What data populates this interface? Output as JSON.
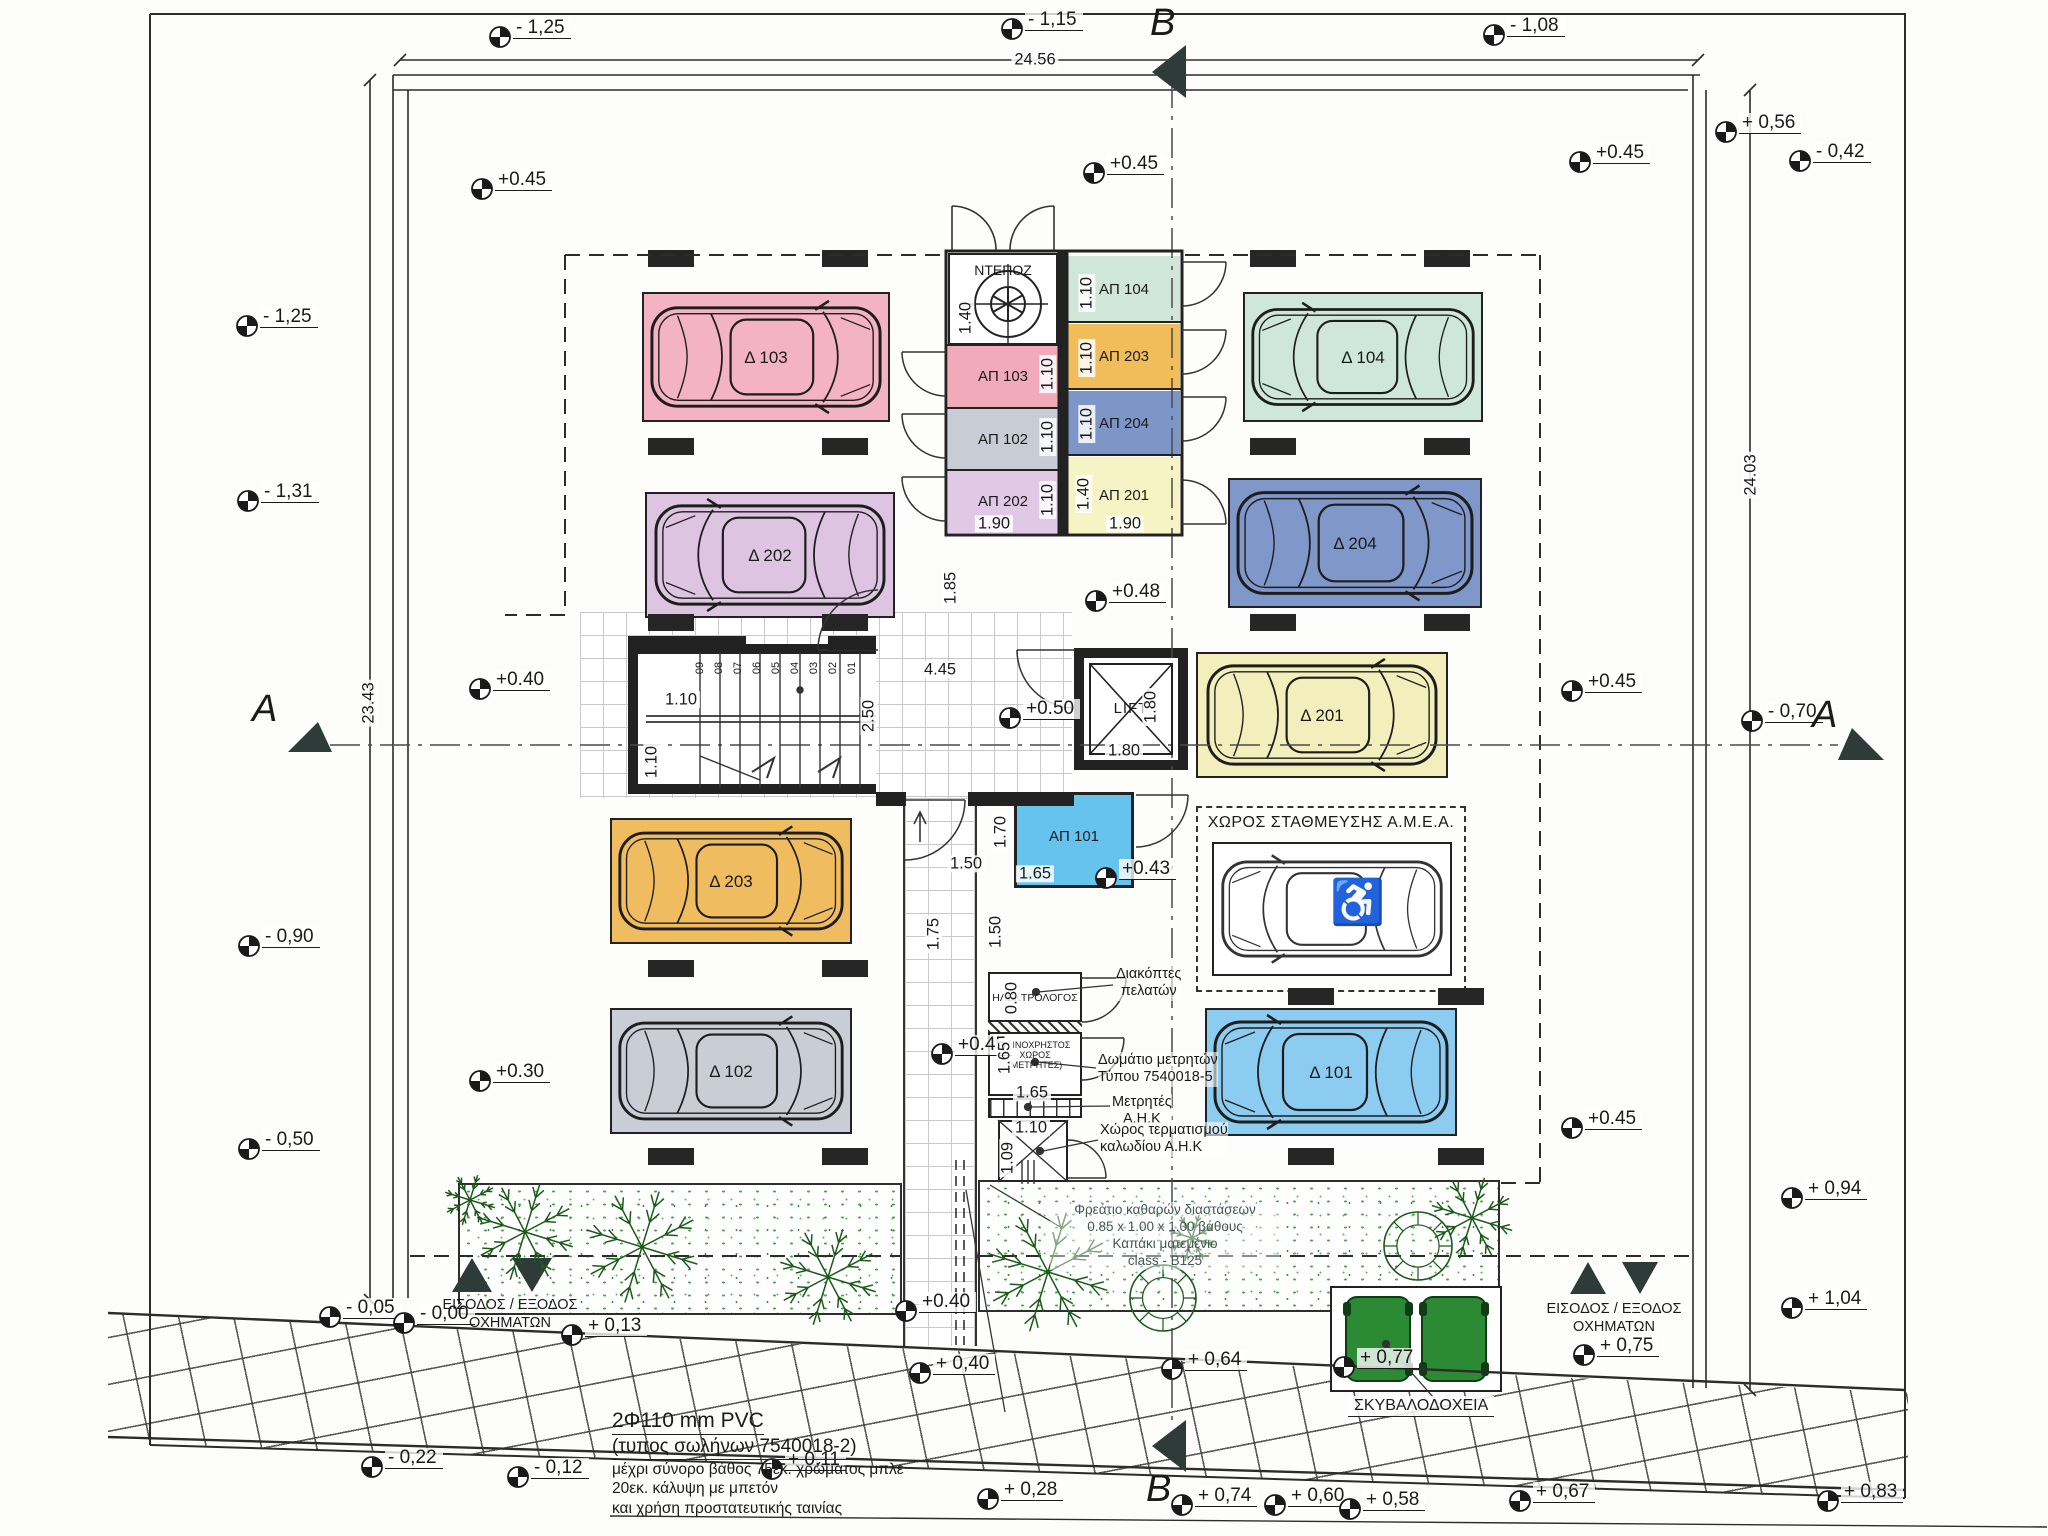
{
  "drawing": {
    "dim_top": "24.56",
    "dim_left": "23.43",
    "dim_right": "24.03",
    "section_a": "A",
    "section_b": "B"
  },
  "core": {
    "lift": "LIFT",
    "deposit": "ΝΤΕΠΟΖ",
    "steps": [
      "09",
      "08",
      "07",
      "06",
      "05",
      "04",
      "03",
      "02",
      "01"
    ]
  },
  "parking": [
    {
      "id": "Δ 103",
      "color": "#f3b3c2"
    },
    {
      "id": "Δ 104",
      "color": "#cfe7da"
    },
    {
      "id": "Δ 202",
      "color": "#ddc5e1"
    },
    {
      "id": "Δ 204",
      "color": "#8097c9"
    },
    {
      "id": "Δ 201",
      "color": "#f3efbc"
    },
    {
      "id": "Δ 203",
      "color": "#efbc60"
    },
    {
      "id": "Δ 102",
      "color": "#c9cdd6"
    },
    {
      "id": "Δ 101",
      "color": "#8cccf0"
    }
  ],
  "storages": [
    {
      "label": "ΑΠ 103",
      "color": "#f0aaba"
    },
    {
      "label": "ΑΠ 102",
      "color": "#c7ccd5"
    },
    {
      "label": "ΑΠ 202",
      "color": "#e0c9e4"
    },
    {
      "label": "ΑΠ 104",
      "color": "#cfe6d9"
    },
    {
      "label": "ΑΠ 203",
      "color": "#f0bd5a"
    },
    {
      "label": "ΑΠ 204",
      "color": "#7e95c8"
    },
    {
      "label": "ΑΠ 201",
      "color": "#f6f3c4"
    }
  ],
  "storage_101": {
    "label": "ΑΠ 101",
    "color": "#66c3ed"
  },
  "amea": {
    "title": "ΧΩΡΟΣ ΣΤΑΘΜΕΥΣΗΣ Α.Μ.Ε.Α.",
    "symbol": "♿"
  },
  "tech": {
    "electrician": "ΗΛΕΚΤΡΟΛΟΓΟΣ",
    "meters_room": [
      "ΚΟΙΝΟΧΡΗΣΤΟΣ",
      "ΧΩΡΟΣ",
      "(ΜΕΤΡΗΤΕΣ)"
    ],
    "ann_switches": [
      "Διακόπτες",
      "πελατών"
    ],
    "ann_meter_room": [
      "Δωμάτιο μετρητών",
      "Τύπου 7540018-5"
    ],
    "ann_meters": [
      "Μετρητές",
      "Α.Η.Κ"
    ],
    "ann_cable": [
      "Χώρος τερματισμού",
      "καλωδίου Α.Η.Κ"
    ]
  },
  "entrances": {
    "line1": "ΕΙΣΟΔΟΣ / ΕΞΟΔΟΣ",
    "line2": "ΟΧΗΜΑΤΩΝ"
  },
  "bins": {
    "label": "ΣΚΥΒΑΛΟΔΟΧΕΙΑ",
    "color": "#2b8a33"
  },
  "notes": {
    "manhole": [
      "Φρεάτιο καθαρών διαστάσεων",
      "0.85 x 1.00 x 1.00 βάθους",
      "Καπάκι ματεμένιο",
      "class - B125"
    ],
    "pvc": [
      "2Φ110 mm PVC",
      "(τυπος σωλήνων  7540018-2)",
      "μέχρι σύνορο βάθος 75εκ.  χρώματος μπλε",
      "20εκ. κάλυψη με μπετόν",
      "και χρήση προστατευτικής ταινίας"
    ]
  },
  "elevations": [
    {
      "v": "- 1,25",
      "x": 500,
      "y": 38
    },
    {
      "v": "- 1,15",
      "x": 1012,
      "y": 30
    },
    {
      "v": "- 1,08",
      "x": 1494,
      "y": 36
    },
    {
      "v": "+ 0,56",
      "x": 1726,
      "y": 133
    },
    {
      "v": "- 0,42",
      "x": 1800,
      "y": 162
    },
    {
      "v": "+0.45",
      "x": 482,
      "y": 190
    },
    {
      "v": "+0.45",
      "x": 1094,
      "y": 174
    },
    {
      "v": "+0.45",
      "x": 1580,
      "y": 163
    },
    {
      "v": "- 1,25",
      "x": 247,
      "y": 327
    },
    {
      "v": "- 1,31",
      "x": 248,
      "y": 502
    },
    {
      "v": "+0.40",
      "x": 480,
      "y": 690
    },
    {
      "v": "+0.45",
      "x": 1572,
      "y": 692
    },
    {
      "v": "- 0,70",
      "x": 1752,
      "y": 722
    },
    {
      "v": "+0.48",
      "x": 1096,
      "y": 602
    },
    {
      "v": "+0.50",
      "x": 1010,
      "y": 719
    },
    {
      "v": "+0.43",
      "x": 1106,
      "y": 879
    },
    {
      "v": "+0.45",
      "x": 942,
      "y": 1055
    },
    {
      "v": "- 0,90",
      "x": 249,
      "y": 947
    },
    {
      "v": "- 0,50",
      "x": 249,
      "y": 1150
    },
    {
      "v": "+0.30",
      "x": 480,
      "y": 1082
    },
    {
      "v": "+0.45",
      "x": 1572,
      "y": 1129
    },
    {
      "v": "+ 0,94",
      "x": 1792,
      "y": 1199
    },
    {
      "v": "+ 1,04",
      "x": 1792,
      "y": 1309
    },
    {
      "v": "- 0,05",
      "x": 330,
      "y": 1318
    },
    {
      "v": "- 0,00",
      "x": 404,
      "y": 1324
    },
    {
      "v": "+ 0,13",
      "x": 572,
      "y": 1336
    },
    {
      "v": "+0.40",
      "x": 906,
      "y": 1312
    },
    {
      "v": "+ 0,40",
      "x": 920,
      "y": 1374
    },
    {
      "v": "+ 0,64",
      "x": 1172,
      "y": 1370
    },
    {
      "v": "+ 0,77",
      "x": 1344,
      "y": 1368
    },
    {
      "v": "+ 0,75",
      "x": 1584,
      "y": 1356
    },
    {
      "v": "- 0,22",
      "x": 372,
      "y": 1468
    },
    {
      "v": "- 0,12",
      "x": 518,
      "y": 1478
    },
    {
      "v": "+ 0,11",
      "x": 772,
      "y": 1470
    },
    {
      "v": "+ 0,28",
      "x": 988,
      "y": 1500
    },
    {
      "v": "+ 0,74",
      "x": 1182,
      "y": 1506
    },
    {
      "v": "+ 0,60",
      "x": 1275,
      "y": 1506
    },
    {
      "v": "+ 0,58",
      "x": 1350,
      "y": 1510
    },
    {
      "v": "+ 0,67",
      "x": 1520,
      "y": 1502
    },
    {
      "v": "+ 0,83",
      "x": 1828,
      "y": 1502
    }
  ],
  "dims": [
    {
      "v": "24.56",
      "x": 1035,
      "y": 60,
      "r": 0
    },
    {
      "v": "23.43",
      "x": 369,
      "y": 703,
      "r": -90
    },
    {
      "v": "24.03",
      "x": 1751,
      "y": 475,
      "r": -90
    },
    {
      "v": "1.40",
      "x": 966,
      "y": 318,
      "r": -90
    },
    {
      "v": "1.10",
      "x": 1048,
      "y": 374,
      "r": -90
    },
    {
      "v": "1.10",
      "x": 1048,
      "y": 437,
      "r": -90
    },
    {
      "v": "1.10",
      "x": 1048,
      "y": 500,
      "r": -90
    },
    {
      "v": "1.10",
      "x": 1087,
      "y": 293,
      "r": -90
    },
    {
      "v": "1.10",
      "x": 1087,
      "y": 358,
      "r": -90
    },
    {
      "v": "1.10",
      "x": 1087,
      "y": 424,
      "r": -90
    },
    {
      "v": "1.40",
      "x": 1084,
      "y": 494,
      "r": -90
    },
    {
      "v": "1.90",
      "x": 994,
      "y": 524,
      "r": 0
    },
    {
      "v": "1.90",
      "x": 1125,
      "y": 524,
      "r": 0
    },
    {
      "v": "1.85",
      "x": 951,
      "y": 588,
      "r": -90
    },
    {
      "v": "4.45",
      "x": 940,
      "y": 670,
      "r": 0
    },
    {
      "v": "2.50",
      "x": 869,
      "y": 716,
      "r": -90
    },
    {
      "v": "1.10",
      "x": 681,
      "y": 700,
      "r": 0
    },
    {
      "v": "1.10",
      "x": 652,
      "y": 762,
      "r": -90
    },
    {
      "v": "1.80",
      "x": 1124,
      "y": 751,
      "r": 0
    },
    {
      "v": "1.80",
      "x": 1151,
      "y": 707,
      "r": -90
    },
    {
      "v": "1.50",
      "x": 966,
      "y": 864,
      "r": 0
    },
    {
      "v": "1.70",
      "x": 1001,
      "y": 832,
      "r": -90
    },
    {
      "v": "1.65",
      "x": 1035,
      "y": 874,
      "r": 0
    },
    {
      "v": "1.50",
      "x": 996,
      "y": 932,
      "r": -90
    },
    {
      "v": "1.75",
      "x": 934,
      "y": 934,
      "r": -90
    },
    {
      "v": "0.80",
      "x": 1012,
      "y": 998,
      "r": -90
    },
    {
      "v": "1.65",
      "x": 1005,
      "y": 1058,
      "r": -90
    },
    {
      "v": "1.65",
      "x": 1032,
      "y": 1093,
      "r": 0
    },
    {
      "v": "1.10",
      "x": 1031,
      "y": 1128,
      "r": 0
    },
    {
      "v": "1.09",
      "x": 1008,
      "y": 1158,
      "r": -90
    }
  ]
}
